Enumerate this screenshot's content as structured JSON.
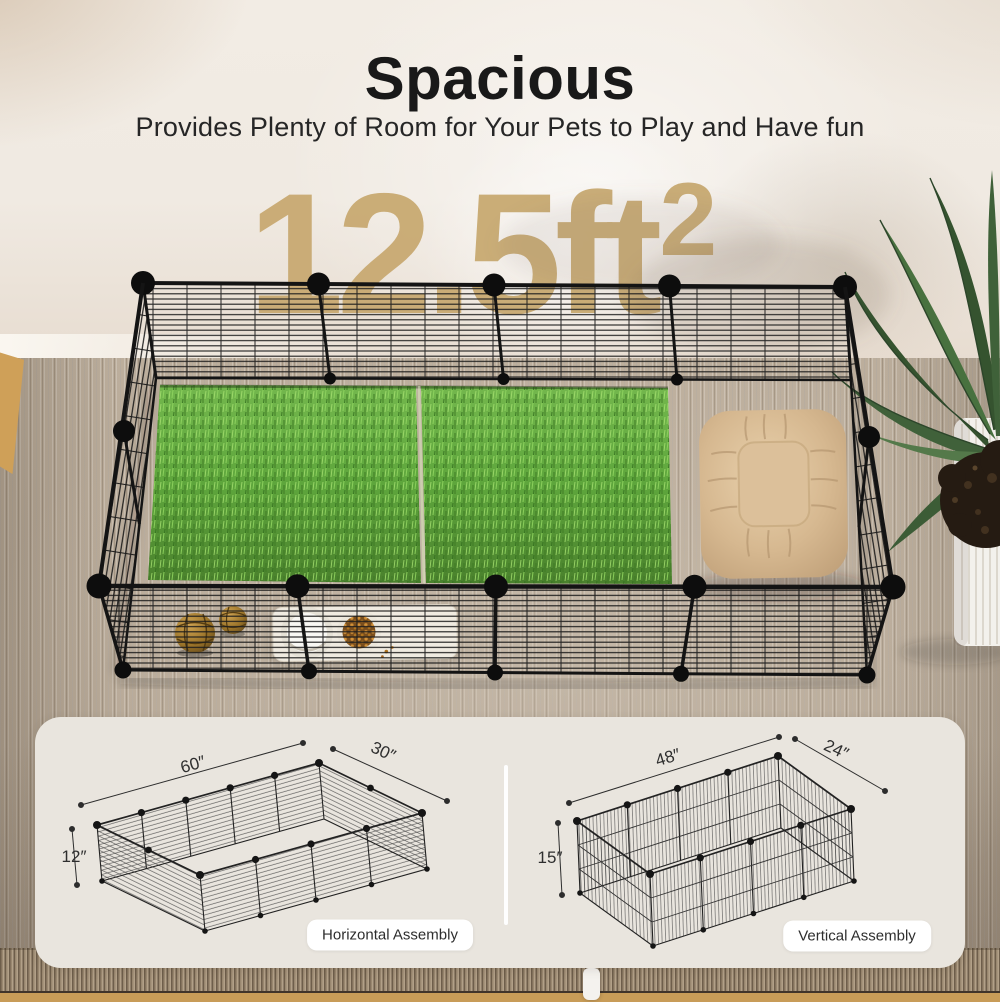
{
  "header": {
    "title": "Spacious",
    "subtitle": "Provides Plenty of Room for Your Pets to Play and Have fun"
  },
  "watermark": {
    "value": "12.5",
    "unit": "ft",
    "exponent": "2"
  },
  "assembly_panel": {
    "diagrams": [
      {
        "name": "horizontal",
        "length": "60″",
        "width": "30″",
        "height": "12″",
        "badge": "Horizontal Assembly"
      },
      {
        "name": "vertical",
        "length": "48″",
        "width": "24″",
        "height": "15″",
        "badge": "Vertical Assembly"
      }
    ]
  },
  "scene": {
    "objects": [
      "wire-playpen",
      "grass-mats",
      "pet-bed",
      "wicker-ball-toys",
      "feeding-mat",
      "food-bowl",
      "water-bowl",
      "potted-palm-plant",
      "area-rug"
    ]
  },
  "colors": {
    "accent_tan": "#c9ab74",
    "wire_black": "#1b1b1b",
    "grass_green": "#5ea63c",
    "bed_beige": "#d6b890",
    "panel_bg": "#e9e5de",
    "wall": "#f0eae2",
    "carpet": "#b6a896"
  }
}
